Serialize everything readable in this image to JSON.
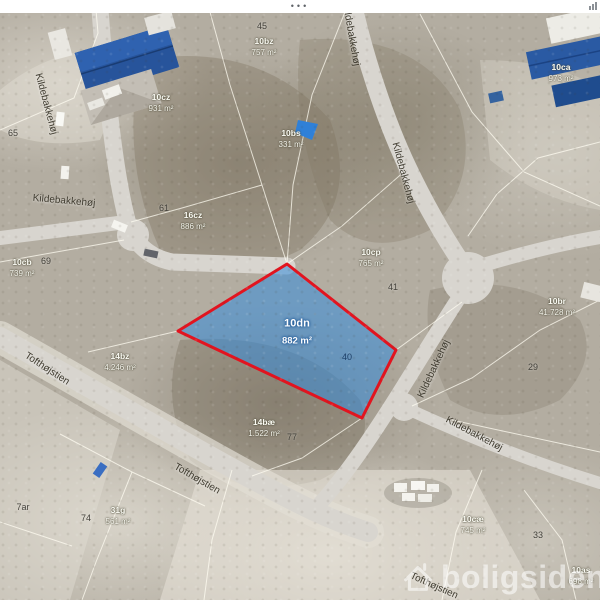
{
  "statusbar": {
    "dots": "•••"
  },
  "watermark": {
    "brand": "boligsiden"
  },
  "map": {
    "colors": {
      "terrain": "#b3ada1",
      "road": "#d8d5cf",
      "parcel_line": "#fffdf4",
      "highlight_fill": "#348cdc",
      "highlight_stroke": "#e2141f",
      "roof_blue": "#27549b"
    },
    "street_names": {
      "kildebakkehoj": "Kildebakkehøj",
      "tofthojstien": "Tofthøjstien"
    },
    "highlight_parcel": {
      "litra": "10dn",
      "area": "882 m²"
    },
    "parcels": [
      {
        "litra": "10bz",
        "area": "757 m²"
      },
      {
        "litra": "10ca",
        "area": "973 m²"
      },
      {
        "litra": "10cz",
        "area": "931 m²"
      },
      {
        "litra": "10bs",
        "area": "331 m²"
      },
      {
        "litra": "16cz",
        "area": "886 m²"
      },
      {
        "litra": "10cb",
        "area": "739 m²"
      },
      {
        "litra": "10cp",
        "area": "765 m²"
      },
      {
        "litra": "10br",
        "area": "41.728 m²"
      },
      {
        "litra": "14bz",
        "area": "4.246 m²"
      },
      {
        "litra": "14bæ",
        "area": "1.522 m²"
      },
      {
        "litra": "31g",
        "area": "561 m²"
      },
      {
        "litra": "10cæ",
        "area": "745 m²"
      },
      {
        "litra": "10as",
        "area": "698 m²"
      }
    ],
    "plot_numbers": [
      "45",
      "65",
      "61",
      "69",
      "41",
      "40",
      "29",
      "77",
      "74",
      "7ar",
      "33"
    ]
  }
}
